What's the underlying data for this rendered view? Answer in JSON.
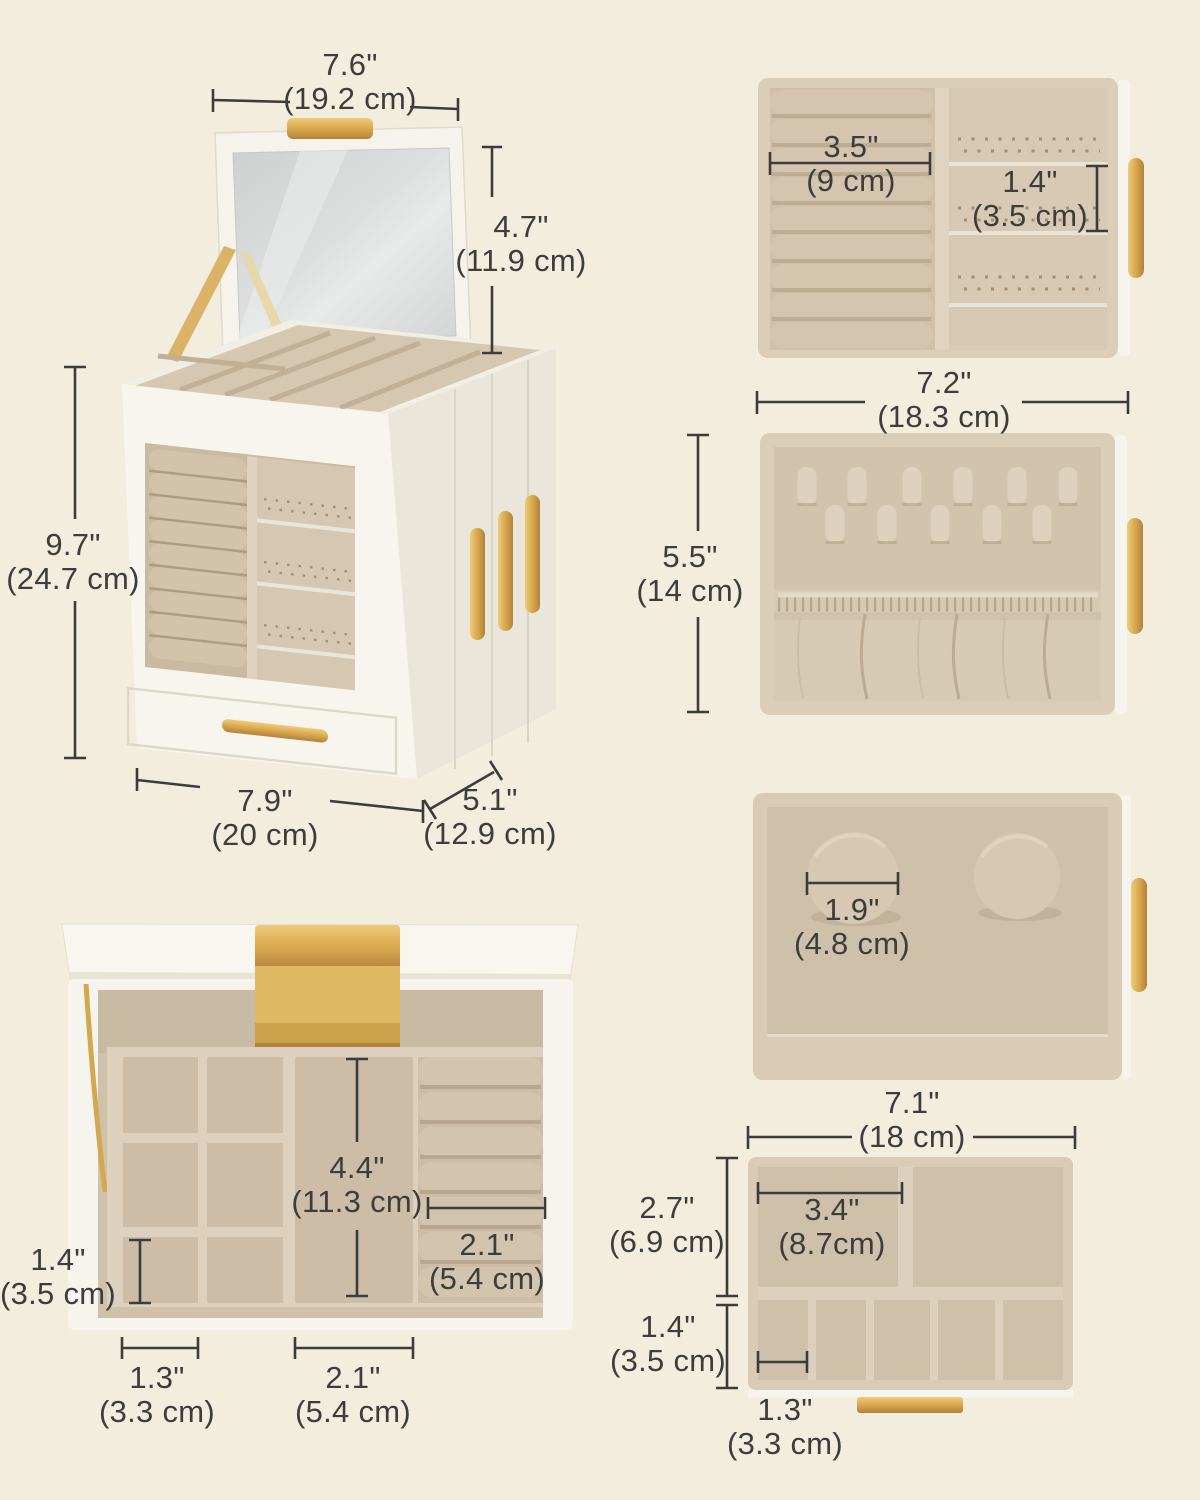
{
  "labels": {
    "box_width_top": {
      "in": "7.6\"",
      "cm": "(19.2 cm)"
    },
    "lid_height": {
      "in": "4.7\"",
      "cm": "(11.9 cm)"
    },
    "box_height": {
      "in": "9.7\"",
      "cm": "(24.7 cm)"
    },
    "box_width": {
      "in": "7.9\"",
      "cm": "(20 cm)"
    },
    "box_depth": {
      "in": "5.1\"",
      "cm": "(12.9 cm)"
    },
    "ring_roll_length": {
      "in": "3.5\"",
      "cm": "(9 cm)"
    },
    "earring_slot": {
      "in": "1.4\"",
      "cm": "(3.5 cm)"
    },
    "tray_width": {
      "in": "7.2\"",
      "cm": "(18.3 cm)"
    },
    "tray_depth": {
      "in": "5.5\"",
      "cm": "(14 cm)"
    },
    "cushion_diameter": {
      "in": "1.9\"",
      "cm": "(4.8 cm)"
    },
    "drawer_width": {
      "in": "7.1\"",
      "cm": "(18 cm)"
    },
    "drawer_big_row": {
      "in": "2.7\"",
      "cm": "(6.9 cm)"
    },
    "drawer_big_cell": {
      "in": "3.4\"",
      "cm": "(8.7cm)"
    },
    "drawer_small_row": {
      "in": "1.4\"",
      "cm": "(3.5 cm)"
    },
    "drawer_small_cell": {
      "in": "1.3\"",
      "cm": "(3.3 cm)"
    },
    "mid_compartment_depth": {
      "in": "4.4\"",
      "cm": "(11.3 cm)"
    },
    "roll_section_width": {
      "in": "2.1\"",
      "cm": "(5.4 cm)"
    },
    "left_cell_height": {
      "in": "1.4\"",
      "cm": "(3.5 cm)"
    },
    "left_cell_width": {
      "in": "1.3\"",
      "cm": "(3.3 cm)"
    },
    "mid_compartment_width": {
      "in": "2.1\"",
      "cm": "(5.4 cm)"
    }
  },
  "colors": {
    "background": "#f2eddd",
    "box_white": "#f7f5ee",
    "velvet": "#d3c4ae",
    "velvet_wall": "#ddd0bc",
    "gold": "#d9a84e",
    "mirror": "#d8dbda",
    "text": "#3d3d3d",
    "dimension_line": "#3c3c3c"
  }
}
